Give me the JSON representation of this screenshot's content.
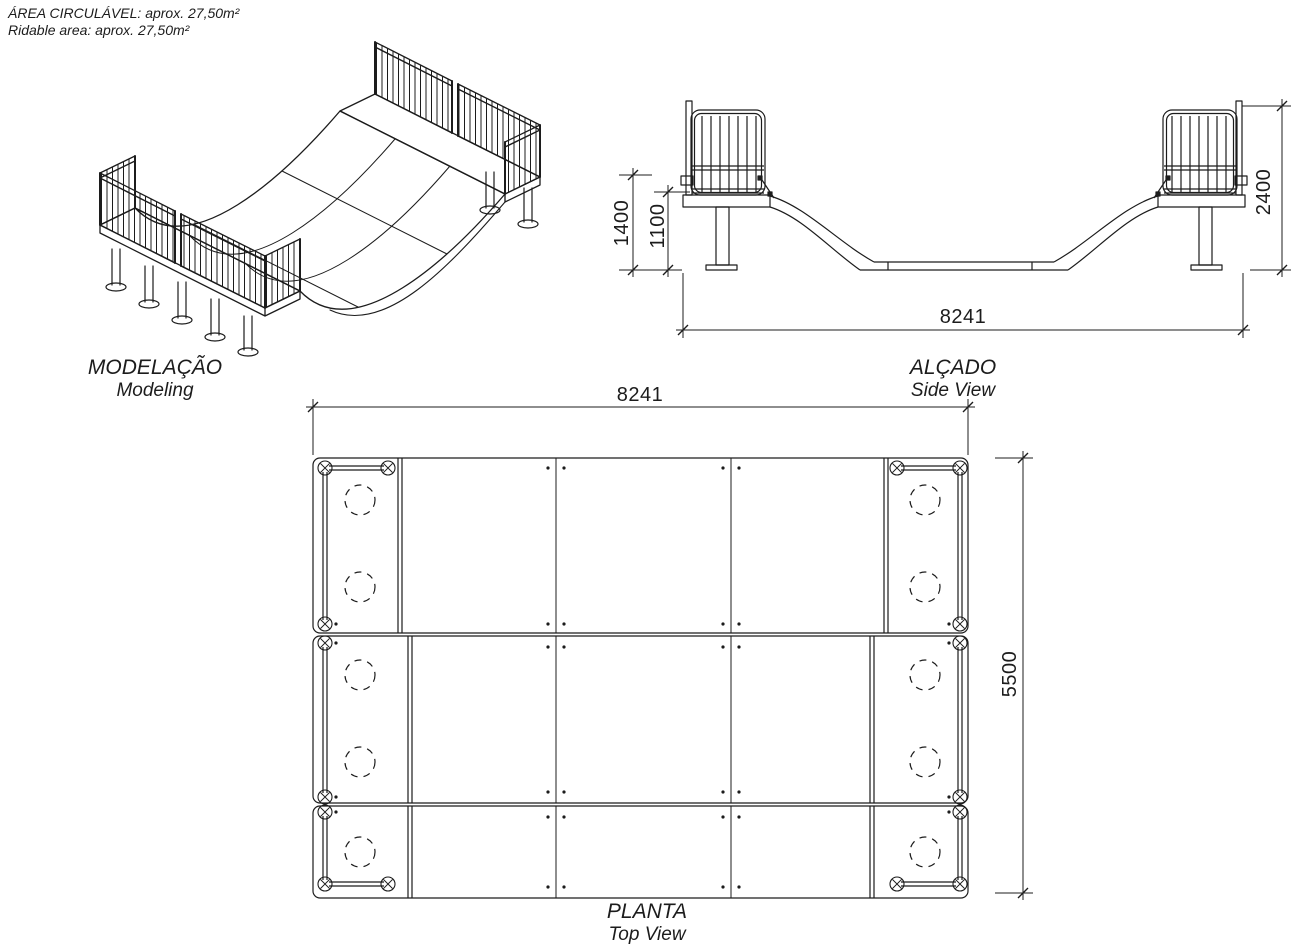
{
  "colors": {
    "background": "#ffffff",
    "line": "#1c1c1c"
  },
  "area_note": {
    "line1": "ÁREA CIRCULÁVEL: aprox. 27,50m²",
    "line2": "Ridable area: aprox. 27,50m²"
  },
  "views": {
    "modeling": {
      "title": "MODELAÇÃO",
      "subtitle": "Modeling"
    },
    "side_view": {
      "title": "ALÇADO",
      "subtitle": "Side View",
      "dimensions": {
        "total_width": "8241",
        "total_height": "2400",
        "coping_height": "1400",
        "deck_height": "1100"
      }
    },
    "top_view": {
      "title": "PLANTA",
      "subtitle": "Top View",
      "dimensions": {
        "width": "8241",
        "depth": "5500"
      }
    }
  }
}
